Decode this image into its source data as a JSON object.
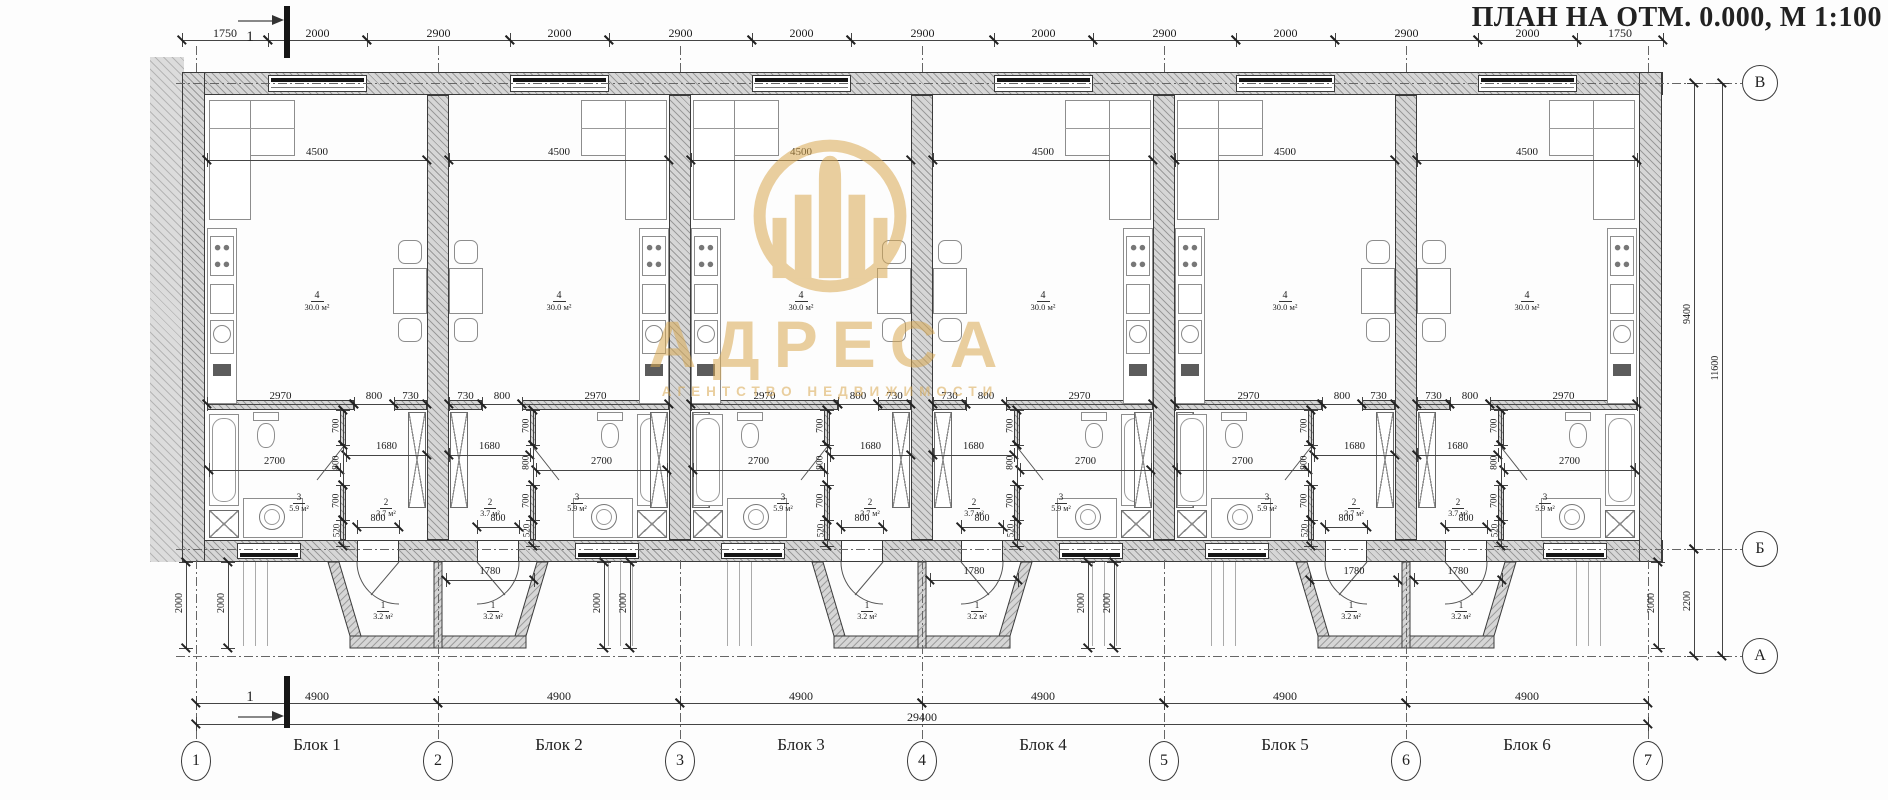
{
  "title": "ПЛАН НА ОТМ. 0.000,  М 1:100",
  "watermark": {
    "logo": "building-in-ring",
    "name": "АДРЕСА",
    "subtitle": "АГЕНТСТВО НЕДВИЖИМОСТИ",
    "color": "#d9a952"
  },
  "section_mark": {
    "label": "1"
  },
  "axes": {
    "vertical": [
      "В",
      "Б",
      "А"
    ],
    "horizontal": [
      "1",
      "2",
      "3",
      "4",
      "5",
      "6",
      "7"
    ]
  },
  "dimensions": {
    "top_row": [
      "1750",
      "2000",
      "2900",
      "2000",
      "2900",
      "2000",
      "2900",
      "2000",
      "2900",
      "2000",
      "2900",
      "2000",
      "1750"
    ],
    "bottom_spans": [
      "4900",
      "4900",
      "4900",
      "4900",
      "4900",
      "4900"
    ],
    "bottom_total": "29400",
    "right": {
      "v_to_b": "9400",
      "v_to_a": "11600",
      "b_to_a": "2200",
      "porch_depth": "2000"
    },
    "block": {
      "living_width": "4500",
      "kitchen_run": "2970",
      "opening": "800",
      "pier": "730",
      "bath_width": "2700",
      "hall_width": "1680",
      "door": "800",
      "porch_width": "1780",
      "vertical_chain": [
        "700",
        "800",
        "700",
        "520"
      ]
    }
  },
  "rooms": {
    "living": {
      "num": "4",
      "area": "30.0 м²"
    },
    "hall": {
      "num": "2",
      "area": "3.7 м²"
    },
    "bath": {
      "num": "3",
      "area": "5.9 м²"
    },
    "porch": {
      "num": "1",
      "area": "3.2 м²"
    }
  },
  "blocks": [
    {
      "label": "Блок 1",
      "mirrored": false,
      "porch_dim_shown": false
    },
    {
      "label": "Блок 2",
      "mirrored": true,
      "porch_dim_shown": true
    },
    {
      "label": "Блок 3",
      "mirrored": false,
      "porch_dim_shown": false
    },
    {
      "label": "Блок 4",
      "mirrored": true,
      "porch_dim_shown": true
    },
    {
      "label": "Блок 5",
      "mirrored": false,
      "porch_dim_shown": true
    },
    {
      "label": "Блок 6",
      "mirrored": true,
      "porch_dim_shown": true
    }
  ]
}
